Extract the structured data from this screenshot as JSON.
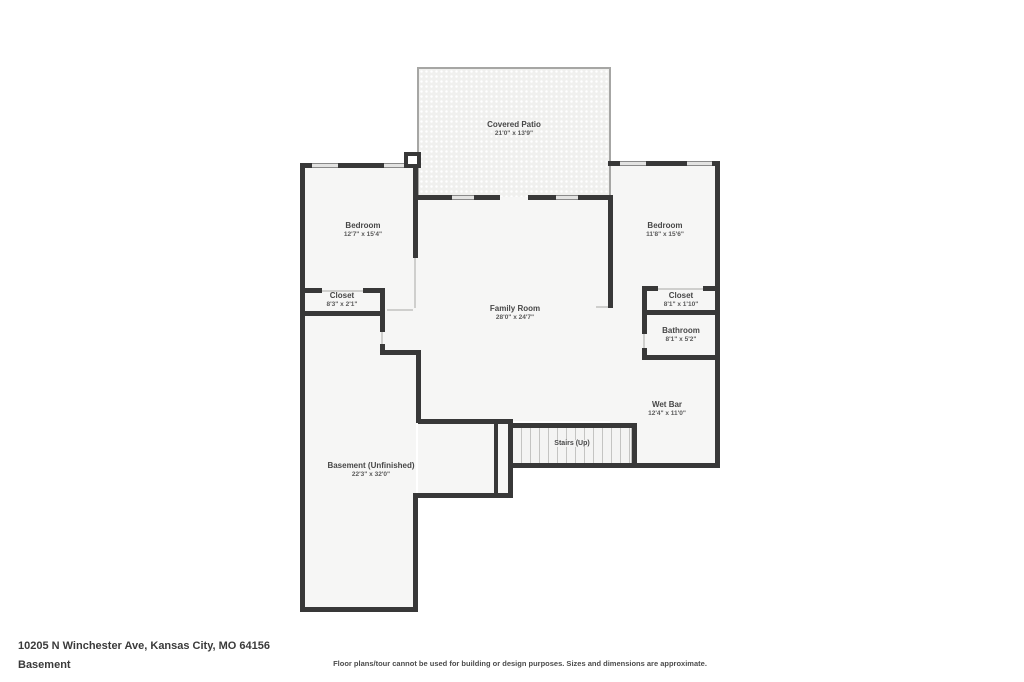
{
  "footer": {
    "address": "10205 N Winchester Ave, Kansas City, MO 64156",
    "level": "Basement",
    "disclaimer": "Floor plans/tour cannot be used for building or design purposes. Sizes and dimensions are approximate."
  },
  "colors": {
    "wall": "#383838",
    "floor_fill": "#f6f6f5",
    "window": "#e3e3e2",
    "door": "#cfcfcd",
    "patio_fill": "#f0f0ee",
    "label_text": "#474747"
  },
  "rooms": [
    {
      "id": "covered-patio",
      "name": "Covered Patio",
      "dims": "21'0\" x 13'9\""
    },
    {
      "id": "bedroom-left",
      "name": "Bedroom",
      "dims": "12'7\" x 15'4\""
    },
    {
      "id": "closet-left",
      "name": "Closet",
      "dims": "8'3\" x 2'1\""
    },
    {
      "id": "family-room",
      "name": "Family Room",
      "dims": "28'0\" x 24'7\""
    },
    {
      "id": "bedroom-right",
      "name": "Bedroom",
      "dims": "11'8\" x 15'6\""
    },
    {
      "id": "closet-right",
      "name": "Closet",
      "dims": "8'1\" x 1'10\""
    },
    {
      "id": "bathroom",
      "name": "Bathroom",
      "dims": "8'1\" x 5'2\""
    },
    {
      "id": "wet-bar",
      "name": "Wet Bar",
      "dims": "12'4\" x 11'0\""
    },
    {
      "id": "stairs",
      "name": "Stairs (Up)",
      "dims": ""
    },
    {
      "id": "basement",
      "name": "Basement (Unfinished)",
      "dims": "22'3\" x 32'0\""
    }
  ]
}
